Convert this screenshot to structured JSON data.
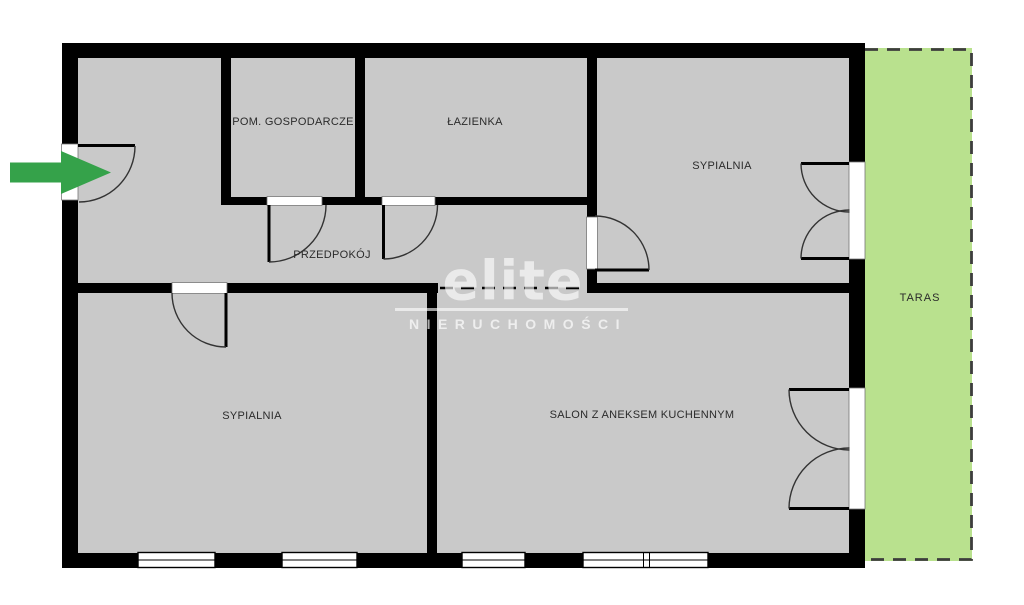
{
  "floor_plan": {
    "rooms": [
      {
        "name": "pom-gospodarcze",
        "label": "POM. GOSPODARCZE"
      },
      {
        "name": "lazienka",
        "label": "ŁAZIENKA"
      },
      {
        "name": "sypialnia-gorna",
        "label": "SYPIALNIA"
      },
      {
        "name": "przedpokoj",
        "label": "PRZEDPOKÓJ"
      },
      {
        "name": "sypialnia-dolna",
        "label": "SYPIALNIA"
      },
      {
        "name": "salon",
        "label": "SALON Z ANEKSEM KUCHENNYM"
      },
      {
        "name": "taras",
        "label": "TARAS"
      }
    ],
    "icons": {
      "entrance_arrow": "green-right-arrow"
    },
    "colors": {
      "room_fill": "#c9c9c9",
      "wall": "#000000",
      "terrace_fill": "#b9e18e",
      "terrace_border": "#3d3d3d",
      "entrance_arrow": "#35a24a",
      "label_text": "#2b2b2b",
      "watermark": "rgba(255,255,255,0.62)"
    }
  },
  "watermark": {
    "brand": "elite",
    "subtitle": "NIERUCHOMOŚCI"
  }
}
